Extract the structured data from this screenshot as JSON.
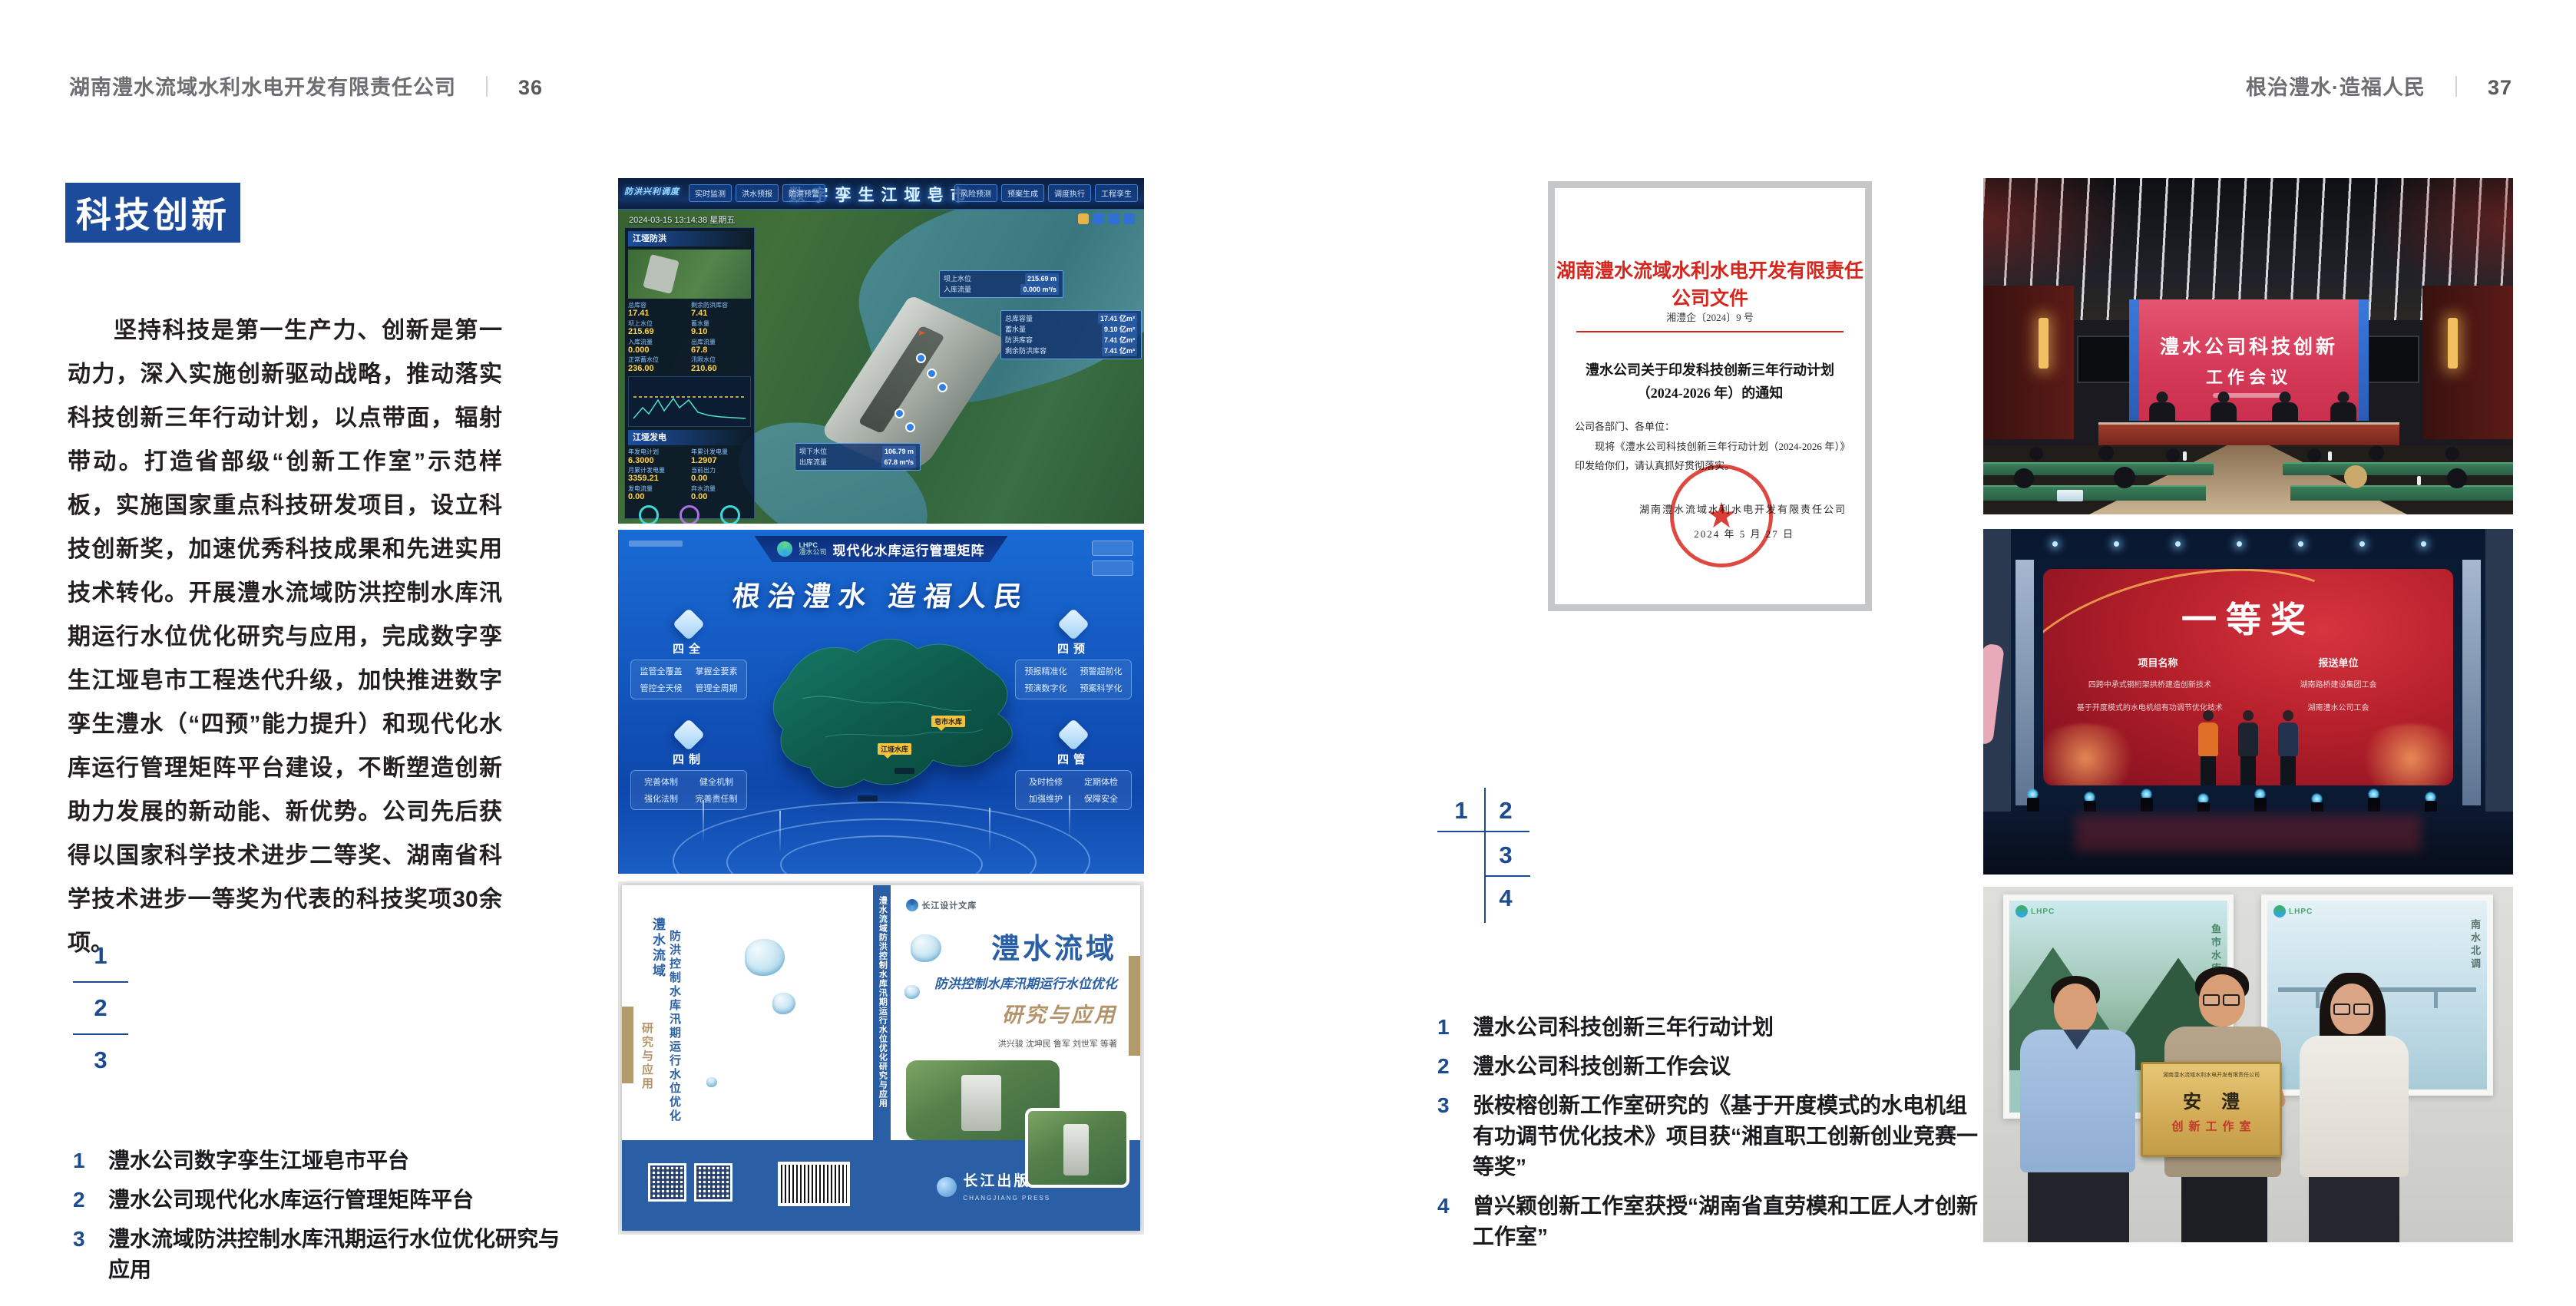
{
  "page_left": {
    "header": {
      "company": "湖南澧水流域水利水电开发有限责任公司",
      "sep": "｜",
      "page": "36"
    },
    "section_title": "科技创新",
    "body": "坚持科技是第一生产力、创新是第一动力，深入实施创新驱动战略，推动落实科技创新三年行动计划，以点带面，辐射带动。打造省部级“创新工作室”示范样板，实施国家重点科技研发项目，设立科技创新奖，加速优秀科技成果和先进实用技术转化。开展澧水流域防洪控制水库汛期运行水位优化研究与应用，完成数字孪生江垭皂市工程迭代升级，加快推进数字孪生澧水（“四预”能力提升）和现代化水库运行管理矩阵平台建设，不断塑造创新助力发展的新动能、新优势。公司先后获得以国家科学技术进步二等奖、湖南省科学技术进步一等奖为代表的科技奖项30余项。",
    "fig_index": [
      "1",
      "2",
      "3"
    ],
    "captions": [
      {
        "no": "1",
        "text": "澧水公司数字孪生江垭皂市平台"
      },
      {
        "no": "2",
        "text": "澧水公司现代化水库运行管理矩阵平台"
      },
      {
        "no": "3",
        "text": "澧水流域防洪控制水库汛期运行水位优化研究与应用"
      }
    ]
  },
  "page_right": {
    "header": {
      "slogan": "根治澧水·造福人民",
      "sep": "｜",
      "page": "37"
    },
    "fig_index": [
      "1",
      "2",
      "3",
      "4"
    ],
    "captions": [
      {
        "no": "1",
        "text": "澧水公司科技创新三年行动计划"
      },
      {
        "no": "2",
        "text": "澧水公司科技创新工作会议"
      },
      {
        "no": "3",
        "text": "张桉榕创新工作室研究的《基于开度模式的水电机组有功调节优化技术》项目获“湘直职工创新创业竞赛一等奖”"
      },
      {
        "no": "4",
        "text": "曾兴颖创新工作室获授“湖南省直劳模和工匠人才创新工作室”"
      }
    ]
  },
  "document": {
    "org_title": "湖南澧水流域水利水电开发有限责任公司文件",
    "doc_no": "湘澧企〔2024〕9 号",
    "subject_line1": "澧水公司关于印发科技创新三年行动计划",
    "subject_line2": "（2024-2026 年）的通知",
    "salutation": "公司各部门、各单位：",
    "body": "现将《澧水公司科技创新三年行动计划（2024-2026 年）》印发给你们，请认真抓好贯彻落实。",
    "signer": "湖南澧水流域水利水电开发有限责任公司",
    "date": "2024 年 5 月 27 日",
    "seal_star": "★"
  },
  "fig_dashboard": {
    "title": "数字孪生江垭皂市",
    "system": "防洪兴利调度",
    "datetime": "2024-03-15 13:14:38 星期五",
    "tabs_left": [
      "实时监测",
      "洪水预报",
      "防洪预警"
    ],
    "tabs_right": [
      "风险预测",
      "预案生成",
      "调度执行",
      "工程孪生"
    ],
    "panel1_title": "江垭防洪",
    "stats1": [
      [
        "总库容",
        "17.41"
      ],
      [
        "剩余防洪库容",
        "7.41"
      ],
      [
        "坝上水位",
        "215.69"
      ],
      [
        "蓄水量",
        "9.10"
      ],
      [
        "入库流量",
        "0.000"
      ],
      [
        "出库流量",
        "67.8"
      ],
      [
        "正常蓄水位",
        "236.00"
      ],
      [
        "汛限水位",
        "210.60"
      ]
    ],
    "panel2_title": "江垭发电",
    "stats2": [
      [
        "年发电计划",
        "6.3000"
      ],
      [
        "年累计发电量",
        "1.2907"
      ],
      [
        "月累计发电量",
        "3359.21"
      ],
      [
        "当前出力",
        "0.00"
      ],
      [
        "发电流量",
        "0.00"
      ],
      [
        "弃水流量",
        "0.00"
      ]
    ],
    "callout1": [
      [
        "坝上水位",
        "215.69 m"
      ],
      [
        "入库流量",
        "0.000 m³/s"
      ]
    ],
    "callout2": [
      [
        "坝下水位",
        "106.79 m"
      ],
      [
        "出库流量",
        "67.8 m³/s"
      ]
    ],
    "callout3": [
      [
        "总库容量",
        "17.41 亿m³"
      ],
      [
        "蓄水量",
        "9.10 亿m³"
      ],
      [
        "防洪库容",
        "7.41 亿m³"
      ],
      [
        "剩余防洪库容",
        "7.41 亿m³"
      ]
    ]
  },
  "fig_matrix": {
    "logo": "LHPC",
    "logo_sub": "澧水公司",
    "app_title": "现代化水库运行管理矩阵",
    "slogan": "根治澧水 造福人民",
    "panels": [
      {
        "title": "四全",
        "items": [
          "监管全覆盖",
          "掌握全要素",
          "管控全天候",
          "管理全周期"
        ]
      },
      {
        "title": "四预",
        "items": [
          "预报精准化",
          "预警超前化",
          "预演数字化",
          "预案科学化"
        ]
      },
      {
        "title": "四制",
        "items": [
          "完善体制",
          "健全机制",
          "强化法制",
          "完善责任制"
        ]
      },
      {
        "title": "四管",
        "items": [
          "及时检修",
          "定期体检",
          "加强维护",
          "保障安全"
        ]
      }
    ],
    "markers": [
      "皂市水库",
      "江垭水库"
    ]
  },
  "fig_book": {
    "series": "长江设计文库",
    "title_main": "澧水流域",
    "title_sub": "防洪控制水库汛期运行水位优化",
    "title_tail": "研究与应用",
    "authors": "洪兴骏  沈坤民  鲁军  刘世军  等著",
    "spine_text": "澧水流域防洪控制水库汛期运行水位优化研究与应用",
    "back_title1": "澧水流域",
    "back_title2": "防洪控制水库汛期运行水位优化",
    "back_title3": "研究与应用",
    "publisher": "长江出版社",
    "publisher_en": "CHANGJIANG PRESS"
  },
  "fig_meeting": {
    "screen_line1": "澧水公司科技创新",
    "screen_line2": "工作会议"
  },
  "fig_award": {
    "title": "一等奖",
    "col1_header": "项目名称",
    "col2_header": "报送单位",
    "col1_rows": [
      "四跨中承式钢桁架拱桥建造创新技术",
      "基于开度模式的水电机组有功调节优化技术"
    ],
    "col2_rows": [
      "湖南路桥建设集团工会",
      "湖南澧水公司工会"
    ]
  },
  "fig_group": {
    "plaque_org": "湖南澧水流域水利水电开发有限责任公司",
    "plaque_title": "安澧",
    "plaque_sub": "创新工作室",
    "poster_logo": "LHPC",
    "poster1_caption": "鱼市水库",
    "poster2_caption": "南水北调"
  }
}
